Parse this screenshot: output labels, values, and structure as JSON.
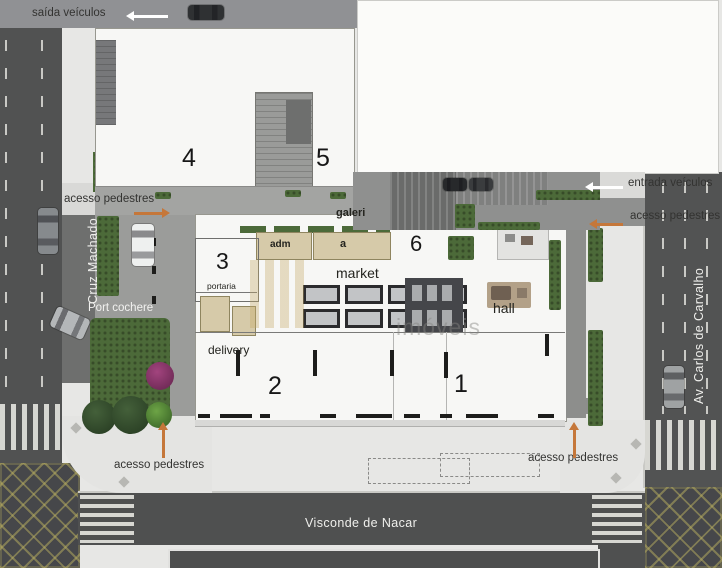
{
  "streets": {
    "left": "Cruz Machado",
    "bottom": "Visconde de Nacar",
    "right": "Av. Carlos de Carvalho"
  },
  "annotations": {
    "exit_vehicles": "saída veículos",
    "entrance_vehicles": "entrada veículos",
    "pedestrian_access": "acesso pedestres",
    "port_cochere": "Port cochere"
  },
  "rooms": {
    "n1": "1",
    "n2": "2",
    "n3": "3",
    "n4": "4",
    "n5": "5",
    "n6": "6",
    "galeria": "galeri",
    "adm": "adm",
    "unit_a": "a",
    "market": "market",
    "hall": "hall",
    "portaria": "portaria",
    "delivery": "delivery"
  },
  "watermark": {
    "text": "imóveis"
  },
  "colors": {
    "road": "#515252",
    "sidewalk": "#e7e7e5",
    "building": "#f7f7f5",
    "shops_beige": "#d6caa9",
    "greenery": "#4c6a39",
    "arrow_orange": "#c5773a",
    "arrow_white": "#ffffff",
    "junction_hatch_yellow": "#bab060",
    "street_text": "#efefec",
    "label_text": "#333331"
  }
}
